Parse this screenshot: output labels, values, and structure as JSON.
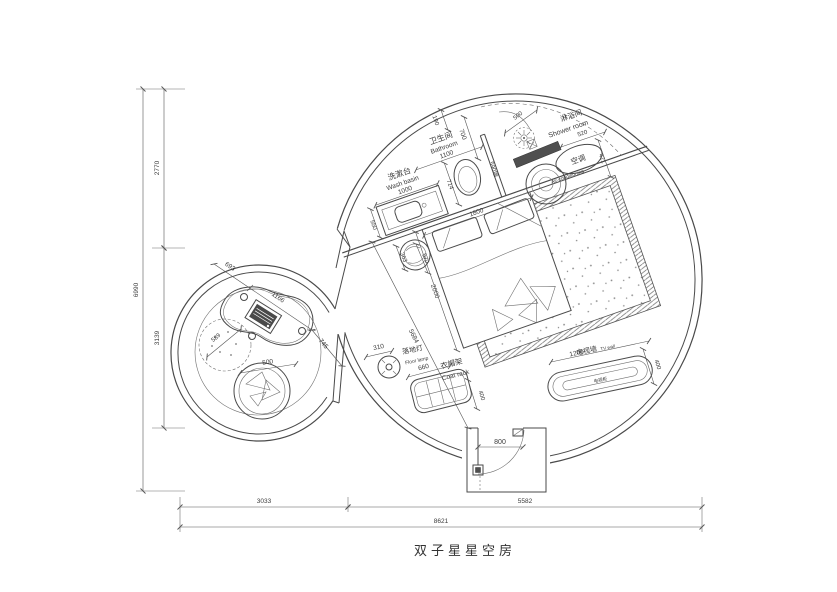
{
  "title": "双子星星空房",
  "outer_dims": {
    "total_height": "6990",
    "height_top": "2770",
    "height_bottom": "3139",
    "width_left": "3033",
    "width_right": "5582",
    "total_width": "8621"
  },
  "washbasin": {
    "label_cn": "洗漱台",
    "label_en": "Wash basin",
    "length": "1000",
    "depth": "550"
  },
  "bathroom": {
    "label_cn": "卫生间",
    "label_en": "Bathroom",
    "width": "1100",
    "offset": "190",
    "door": "700",
    "shower_door": "500",
    "wall": "590墙",
    "toilet": "714"
  },
  "shower": {
    "label_cn": "淋浴间",
    "label_en": "Shower room",
    "bench": "520",
    "depth": "421"
  },
  "ac": {
    "label_cn": "空调",
    "label_en": "Air-conditioning"
  },
  "bed": {
    "width": "1800",
    "length": "2000",
    "stool_offset": "363",
    "stool": "570",
    "diagonal": "5684"
  },
  "lamp": {
    "label_cn": "落地灯",
    "label_en": "Floor lamp",
    "dim": "310"
  },
  "coatrack": {
    "label_cn": "衣帽架",
    "label_en": "Coat rack",
    "width": "660",
    "depth": "400"
  },
  "tv": {
    "label_cn": "电视墙",
    "label_en": "TV wall",
    "cabinet": "电视柜",
    "length": "1200",
    "depth": "400"
  },
  "entrance": {
    "door": "800"
  },
  "lounge": {
    "seg1": "693",
    "seg2": "1166",
    "seg3": "745",
    "beanbag": "589",
    "seat": "500"
  },
  "colors": {
    "line": "#4a4a4a",
    "dark_fill": "#4f4f4f"
  }
}
